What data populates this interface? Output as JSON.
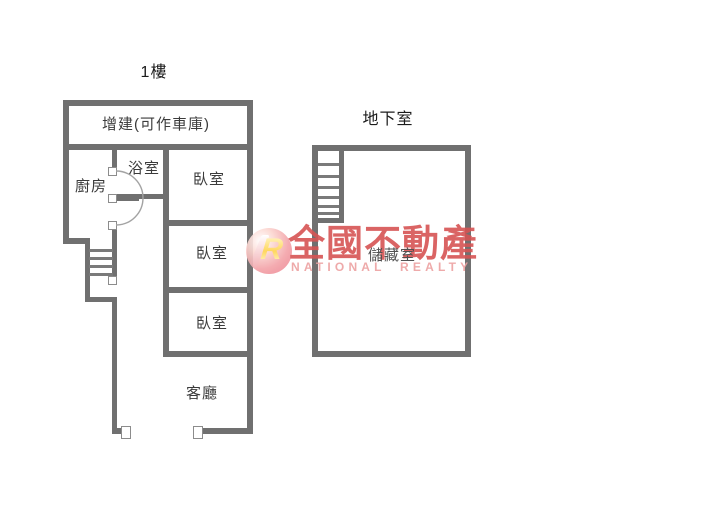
{
  "page": {
    "background": "#ffffff",
    "width": 701,
    "height": 506
  },
  "colors": {
    "wall": "#707070",
    "room_label": "#3b3b3b",
    "title": "#1b1b1b",
    "watermark_red": "#d75454",
    "watermark_pink": "#eda1a1",
    "logo_pink": "#ec8290",
    "logo_yellow": "#ffd34d"
  },
  "floor1": {
    "title": "1樓",
    "rooms": {
      "addition": "增建(可作車庫)",
      "bathroom": "浴室",
      "kitchen": "廚房",
      "bedroom1": "臥室",
      "bedroom2": "臥室",
      "bedroom3": "臥室",
      "living": "客廳"
    }
  },
  "basement": {
    "title": "地下室",
    "rooms": {
      "storage": "儲藏室"
    }
  },
  "watermark": {
    "brand": "全國不動產",
    "subtitle": "NATIONAL REALTY",
    "logo_letter": "R"
  }
}
